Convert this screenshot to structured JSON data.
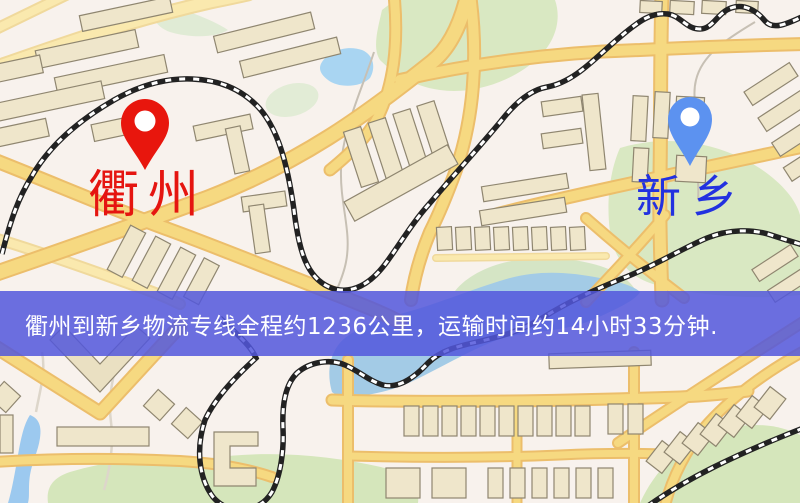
{
  "markers": {
    "origin": {
      "label": "衢州",
      "pin_color": "#e8160d",
      "label_color": "#e51510"
    },
    "destination": {
      "label": "新乡",
      "pin_color": "#5c92f0",
      "label_color": "#2231e0"
    }
  },
  "banner": {
    "text": "衢州到新乡物流专线全程约1236公里，运输时间约14小时33分钟.",
    "background_color": "#5b5fd9",
    "text_color": "#ffffff",
    "route": {
      "origin": "衢州",
      "destination": "新乡",
      "distance": "约1236公里",
      "duration": "约14小时33分钟"
    }
  },
  "map_colors": {
    "background": "#f8f2ed",
    "road_fill": "#f6d981",
    "road_casing": "#ecbe6b",
    "building_fill": "#efe6cb",
    "green_area": "#d9e8c2",
    "water": "#a5cdee",
    "railway": "#222222"
  }
}
